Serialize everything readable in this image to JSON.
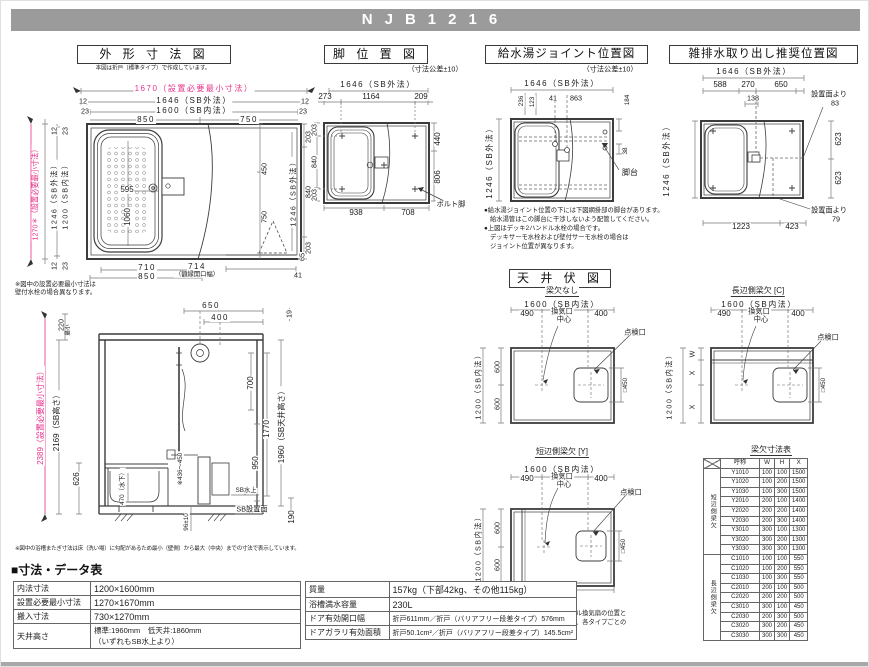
{
  "page": {
    "model": "NJB1216"
  },
  "sec_gaikei": {
    "title": "外 形 寸 法 図",
    "subnote": "本図は折戸（標準タイプ）で作成しています。",
    "plan": {
      "min_w": "1670（設置必要最小寸法）",
      "sb_out_w": "1646（SB外法）",
      "sb_in_w": "1600（SB内法）",
      "n12": "12",
      "n23": "23",
      "n850": "850",
      "n750": "750",
      "min_h": "1270＊（設置必要最小寸法）",
      "sb_out_h": "1246（SB外法）",
      "sb_in_h": "1200（SB内法）",
      "tub_w": "595",
      "tub_l": "1060",
      "r203a": "203",
      "r840": "840",
      "r203b": "203",
      "r_sb_out": "1246（SB外法）",
      "i450": "450",
      "i750": "750",
      "i65": "65",
      "b710": "710",
      "b850": "850",
      "b714": "714",
      "b714_cap": "（額縁開口幅）",
      "b41": "41",
      "note1": "※図中の設置必要最小寸法は",
      "note2": "壁付水栓の場合異なります。"
    },
    "side": {
      "t650": "650",
      "t400": "400",
      "r19": "19",
      "l220": "220",
      "l220cap": "最小",
      "min_h": "2389（設置必要最小寸法）",
      "sb_h": "2169（SB高さ）",
      "l626": "626",
      "tub470": "470（水下）",
      "matagi": "※436〜450",
      "r700": "700",
      "r1770": "1770",
      "r950": "950",
      "ceil": "1960（SB天井高さ）",
      "r190": "190",
      "sb_top": "SB水上",
      "sb_face": "SB設置面",
      "b96": "96±10"
    },
    "side_note": "※図中の浴槽またぎ寸法は床（洗い場）に勾配があるため最小（壁側）から最大（中央）までの寸法で表示しています。"
  },
  "sec_ashi": {
    "title": "脚 位 置 図",
    "tol": "（寸法公差±10）",
    "sb_out_w": "1646（SB外法）",
    "t273": "273",
    "t1164": "1164",
    "t209": "209",
    "l203a": "203",
    "l840": "840",
    "l203b": "203",
    "r440": "440",
    "r806": "806",
    "b938": "938",
    "b708": "708",
    "bolt": "ボルト脚"
  },
  "sec_kyusui": {
    "title": "給水湯ジョイント位置図",
    "tol": "（寸法公差±10）",
    "sb_out_w": "1646（SB外法）",
    "t236": "236",
    "t123": "123",
    "t41": "41",
    "t863": "863",
    "r184": "184",
    "r38": "38",
    "sb_out_h": "1246（SB外法）",
    "dai": "脚台",
    "notes": [
      "●給水湯ジョイント位置の下には下図網掛部の脚台があります。",
      "給水湯管はこの脚台に干渉しないよう配管してください。",
      "●上図はデッキ2ハンドル水栓の場合です。",
      "デッキサーモ水栓および壁付サーモ水栓の場合は",
      "ジョイント位置が異なります。"
    ]
  },
  "sec_haisui": {
    "title": "雑排水取り出し推奨位置図",
    "sb_out_w": "1646（SB外法）",
    "t588": "588",
    "t270": "270",
    "t650": "650",
    "t138": "138",
    "sb_out_h": "1246（SB外法）",
    "r623a": "623",
    "r623b": "623",
    "men83a": "設置面より",
    "men83b": "83",
    "men79a": "設置面より",
    "men79b": "79",
    "b1223": "1223",
    "b423": "423"
  },
  "ceiling": {
    "title": "天 井 伏 図",
    "a_name": "梁欠なし",
    "b_name": "長辺側梁欠 [C]",
    "c_name": "短辺側梁欠 [Y]",
    "sb_in_w": "1600（SB内法）",
    "sb_in_h": "1200（SB内法）",
    "t490": "490",
    "t400": "400",
    "vent1": "換気口",
    "vent2": "中心",
    "access": "点検口",
    "n600": "600",
    "sq450": "□450",
    "W": "W",
    "X": "X",
    "note": [
      "※換気口中心はフラットパネル換気扇の位置と",
      "なります。その他の場合は、各タイプごとの",
      "図面にてご確認ください。"
    ],
    "table": {
      "title": "梁欠寸法表",
      "headers": [
        "呼称",
        "W",
        "H",
        "X"
      ],
      "groups": [
        {
          "name": "短辺側梁欠",
          "rows": [
            [
              "Y1010",
              "100",
              "100",
              "1500"
            ],
            [
              "Y1020",
              "100",
              "200",
              "1500"
            ],
            [
              "Y1030",
              "100",
              "300",
              "1500"
            ],
            [
              "Y2010",
              "200",
              "100",
              "1400"
            ],
            [
              "Y2020",
              "200",
              "200",
              "1400"
            ],
            [
              "Y2030",
              "200",
              "300",
              "1400"
            ],
            [
              "Y3010",
              "300",
              "100",
              "1300"
            ],
            [
              "Y3020",
              "300",
              "200",
              "1300"
            ],
            [
              "Y3030",
              "300",
              "300",
              "1300"
            ]
          ]
        },
        {
          "name": "長辺側梁欠",
          "rows": [
            [
              "C1010",
              "100",
              "100",
              "550"
            ],
            [
              "C1020",
              "100",
              "200",
              "550"
            ],
            [
              "C1030",
              "100",
              "300",
              "550"
            ],
            [
              "C2010",
              "200",
              "100",
              "500"
            ],
            [
              "C2020",
              "200",
              "200",
              "500"
            ],
            [
              "C3010",
              "300",
              "100",
              "450"
            ],
            [
              "C2030",
              "200",
              "300",
              "500"
            ],
            [
              "C3020",
              "300",
              "200",
              "450"
            ],
            [
              "C3030",
              "300",
              "300",
              "450"
            ]
          ]
        }
      ]
    }
  },
  "datasheet": {
    "heading": "■寸法・データ表",
    "left": [
      {
        "label": "内法寸法",
        "value": "1200×1600mm"
      },
      {
        "label": "設置必要最小寸法",
        "value": "1270×1670mm"
      },
      {
        "label": "搬入寸法",
        "value": "730×1270mm"
      },
      {
        "label": "天井高さ",
        "value": "標準:1960mm　低天井:1860mm",
        "value2": "（いずれもSB水上より）"
      }
    ],
    "right": [
      {
        "label": "質量",
        "value": "157kg（下部42kg、その他115kg）"
      },
      {
        "label": "浴槽満水容量",
        "value": "230L"
      },
      {
        "label": "ドア有効開口幅",
        "value": "折戸611mm／折戸（バリアフリー段差タイプ）576mm"
      },
      {
        "label": "ドアガラリ有効面積",
        "value": "折戸50.1cm²／折戸（バリアフリー段差タイプ）145.5cm²"
      }
    ]
  }
}
